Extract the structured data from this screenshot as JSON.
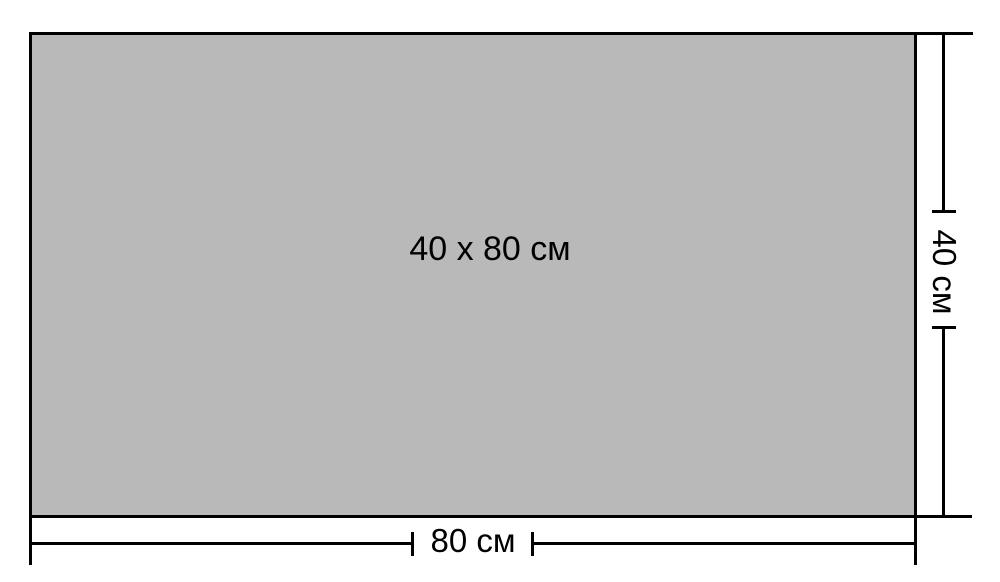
{
  "diagram": {
    "size_label": "40 x 80 см",
    "width_label": "80 см",
    "height_label": "40 см",
    "colors": {
      "rect_fill": "#b9b9b9",
      "line": "#000000",
      "background": "#ffffff"
    }
  }
}
